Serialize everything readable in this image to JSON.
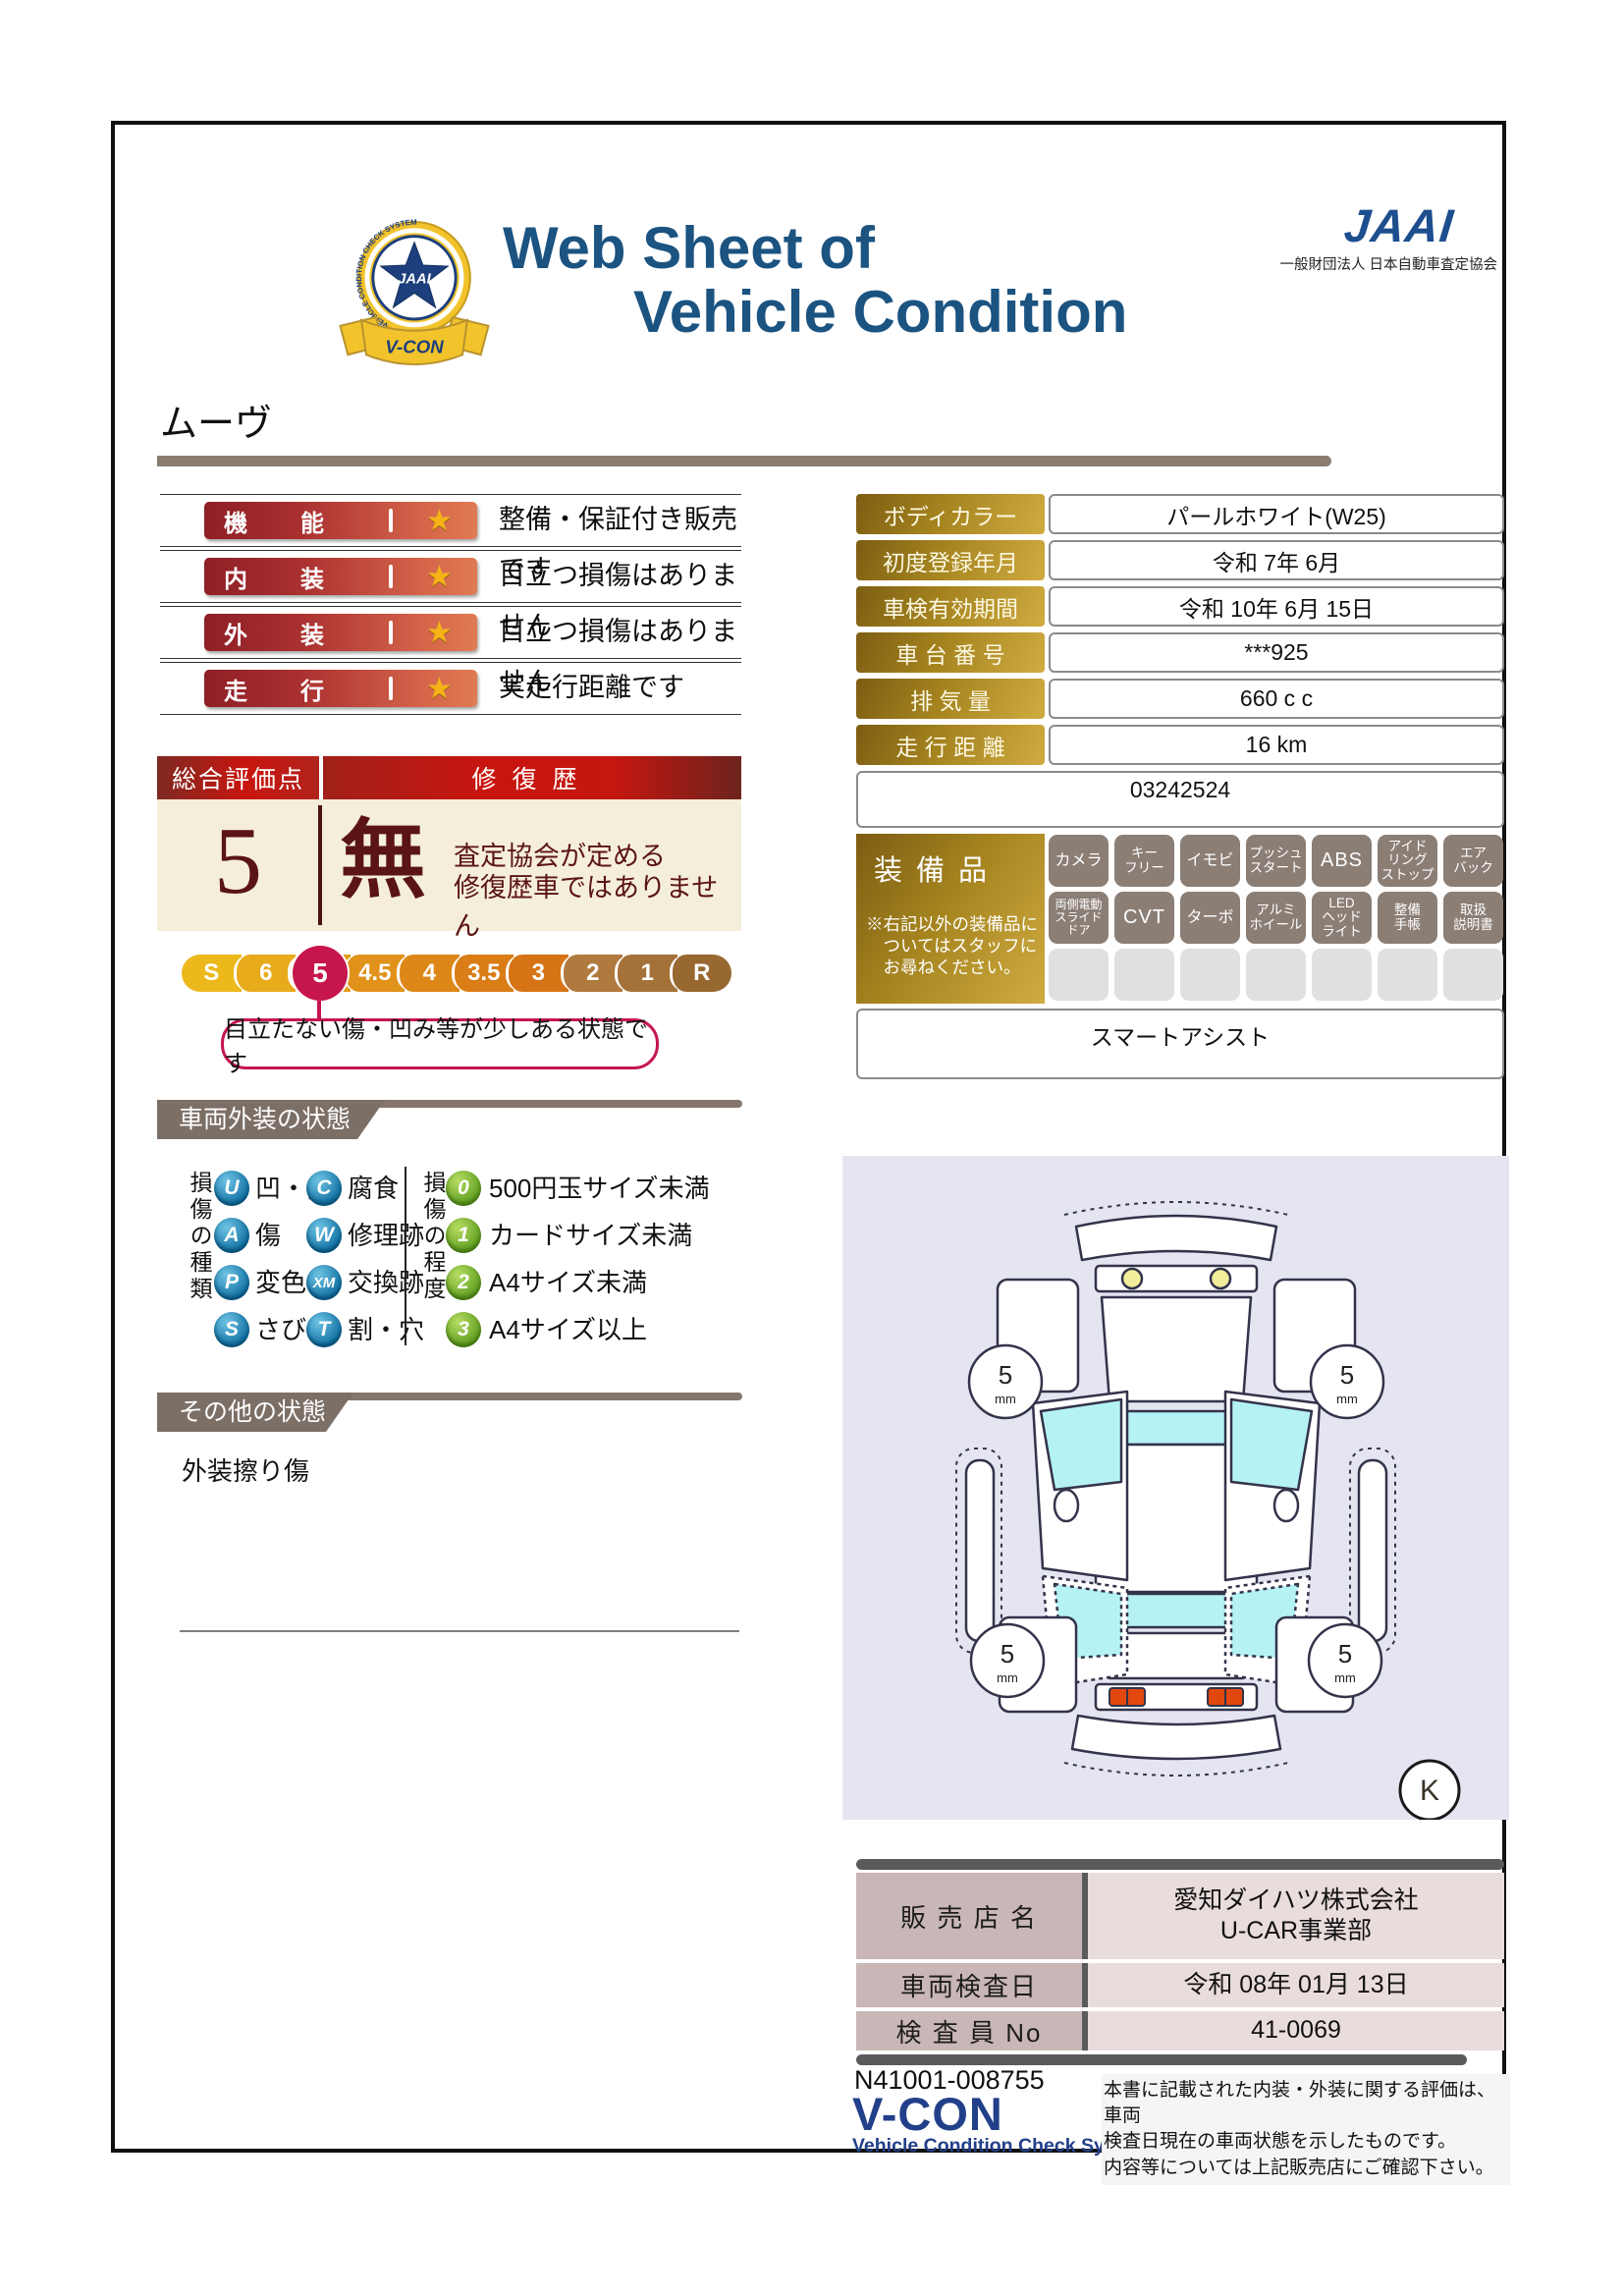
{
  "header": {
    "title_line1": "Web Sheet of",
    "title_line2": "Vehicle Condition",
    "jaai_wordmark": "JAAI",
    "jaai_org": "一般財団法人 日本自動車査定協会",
    "emblem": {
      "star_text": "JAAI",
      "ring_text": "VEHICLE CONDITION CHECK SYSTEM",
      "ribbon_text": "V-CON"
    }
  },
  "vehicle_name": "ムーヴ",
  "ratings": [
    {
      "label": "機能",
      "desc": "整備・保証付き販売です"
    },
    {
      "label": "内装",
      "desc": "目立つ損傷はありません"
    },
    {
      "label": "外装",
      "desc": "目立つ損傷はありません"
    },
    {
      "label": "走行",
      "desc": "実走行距離です"
    }
  ],
  "overall": {
    "header_left": "総合評価点",
    "header_right": "修復歴",
    "score": "5",
    "repair_flag": "無",
    "repair_line1": "査定協会が定める",
    "repair_line2": "修復歴車ではありません"
  },
  "scale": {
    "levels": [
      "S",
      "6",
      "5",
      "4.5",
      "4",
      "3.5",
      "3",
      "2",
      "1",
      "R"
    ],
    "selected": "5",
    "callout": "目立たない傷・凹み等が少しある状態です"
  },
  "exterior_section": {
    "title": "車両外装の状態",
    "type_label": "損傷の種類",
    "degree_label": "損傷の程度",
    "types": [
      {
        "code": "U",
        "label": "凹・曲"
      },
      {
        "code": "C",
        "label": "腐食"
      },
      {
        "code": "A",
        "label": "傷"
      },
      {
        "code": "W",
        "label": "修理跡"
      },
      {
        "code": "P",
        "label": "変色"
      },
      {
        "code": "XM",
        "label": "交換跡"
      },
      {
        "code": "S",
        "label": "さび"
      },
      {
        "code": "T",
        "label": "割・穴"
      }
    ],
    "degrees": [
      {
        "code": "0",
        "label": "500円玉サイズ未満"
      },
      {
        "code": "1",
        "label": "カードサイズ未満"
      },
      {
        "code": "2",
        "label": "A4サイズ未満"
      },
      {
        "code": "3",
        "label": "A4サイズ以上"
      }
    ]
  },
  "other_section": {
    "title": "その他の状態",
    "note": "外装擦り傷"
  },
  "info": {
    "rows": [
      {
        "label": "ボディカラー",
        "value": "パールホワイト(W25)"
      },
      {
        "label": "初度登録年月",
        "value": "令和 7年 6月"
      },
      {
        "label": "車検有効期間",
        "value": "令和 10年 6月 15日"
      },
      {
        "label": "車 台 番 号",
        "value": "***925"
      },
      {
        "label": "排  気  量",
        "value": "660 c c"
      },
      {
        "label": "走 行 距 離",
        "value": "16 km"
      }
    ],
    "ref": "03242524"
  },
  "equipment": {
    "title": "装備品",
    "note": "※右記以外の装備品に\n　ついてはスタッフに\n　お尋ねください。",
    "items": [
      "カメラ",
      "キー\nフリー",
      "イモビ",
      "プッシュ\nスタート",
      "ABS",
      "アイド\nリング\nストップ",
      "エア\nバック",
      "両側電動\nスライド\nドア",
      "CVT",
      "ターボ",
      "アルミ\nホイール",
      "LED\nヘッド\nライト",
      "整備\n手帳",
      "取扱\n説明書"
    ],
    "extra": "スマートアシスト"
  },
  "diagram": {
    "wheel_value": "5",
    "wheel_unit": "mm",
    "marker": "K"
  },
  "dealer": {
    "rows": [
      {
        "label": "販 売 店 名",
        "value": "愛知ダイハツ株式会社\nU-CAR事業部"
      },
      {
        "label": "車両検査日",
        "value": "令和 08年 01月 13日"
      },
      {
        "label": "検 査 員 No",
        "value": "41-0069"
      }
    ]
  },
  "footer": {
    "doc_no": "N41001-008755",
    "brand": "V-CON",
    "brand_sub": "Vehicle Condition Check System",
    "disclaimer": "本書に記載された内装・外装に関する評価は、車両\n検査日現在の車両状態を示したものです。\n内容等については上記販売店にご確認下さい。"
  },
  "colors": {
    "title_navy": "#1b5381",
    "badge_red_dark": "#8e1f26",
    "badge_red_light": "#e07b52",
    "gold_dark": "#7c5d12",
    "gold_light": "#d0ab41",
    "scale_pin_red": "#c6164d",
    "cream": "#f5eedb",
    "maroon": "#5b1414",
    "taupe_header": "#7c6f66",
    "diagram_bg": "#e5e5f2",
    "glass_cyan": "#b5f2f4",
    "dealer_label_pink": "#c9b6b6",
    "dealer_value_pink": "#e9dcdc"
  }
}
